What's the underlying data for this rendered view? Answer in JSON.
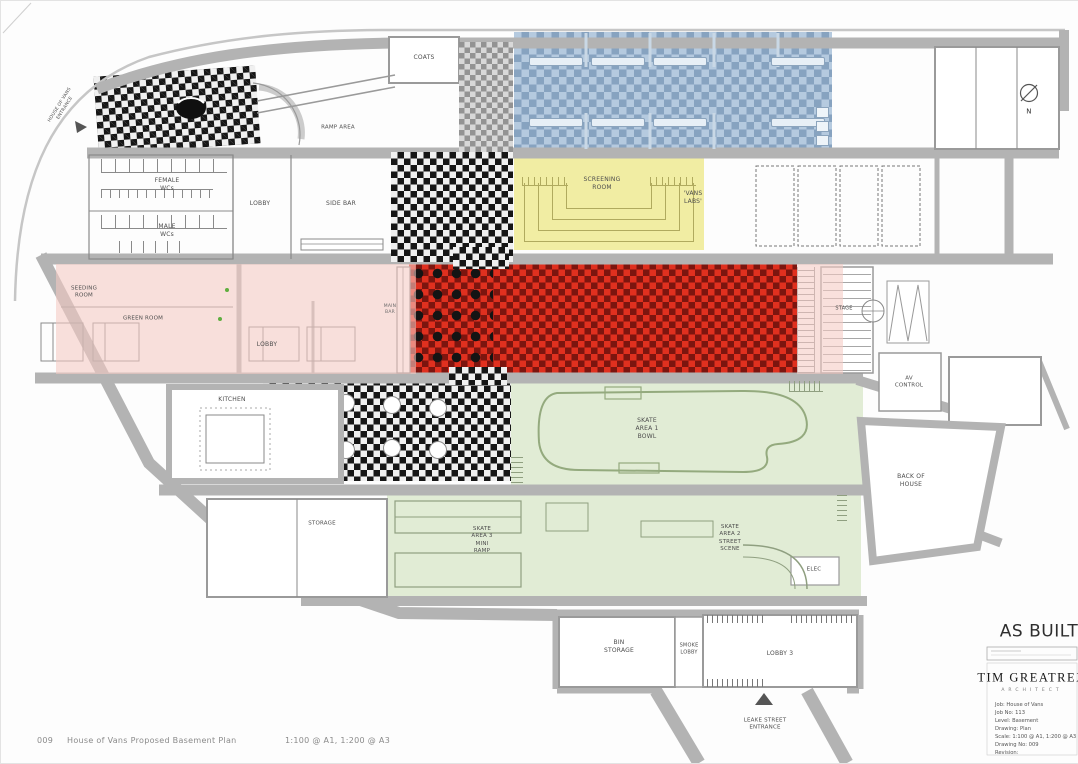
{
  "rooms": {
    "coats": "COATS",
    "ramp_area": "RAMP AREA",
    "hov_entrance": "HOUSE OF VANS\nENTRANCE",
    "female_wcs": "FEMALE\nWCs",
    "male_wcs": "MALE\nWCs",
    "lobby": "LOBBY",
    "side_bar": "SIDE BAR",
    "screening_room": "SCREENING\nROOM",
    "vans_labs": "'VANS\nLABS'",
    "seeding_room": "SEEDING\nROOM",
    "green_room": "GREEN ROOM",
    "lobby2": "LOBBY",
    "main_bar": "MAIN\nBAR",
    "stage": "STAGE",
    "av_control": "AV\nCONTROL",
    "kitchen": "KITCHEN",
    "skate_area_1": "SKATE\nAREA 1\nBOWL",
    "storage": "STORAGE",
    "skate_area_3": "SKATE\nAREA 3\nMINI\nRAMP",
    "skate_area_2": "SKATE\nAREA 2\nSTREET\nSCENE",
    "elec": "ELEC",
    "back_of_house": "BACK OF\nHOUSE",
    "bin_storage": "BIN\nSTORAGE",
    "smoke_lobby": "SMOKE\nLOBBY",
    "lobby3": "LOBBY 3",
    "leake_entrance": "LEAKE STREET\nENTRANCE",
    "north": "N"
  },
  "title_block": {
    "status": "AS BUILT",
    "firm": "TIM GREATREX",
    "firm_sub": "ARCHITECT",
    "info": [
      "Job: House of Vans",
      "Job No: 113",
      "Level: Basement",
      "Drawing: Plan",
      "Scale: 1:100 @ A1, 1:200 @ A3",
      "Drawing No: 009",
      "Revision:"
    ]
  },
  "footer": {
    "number": "009",
    "title": "House of Vans Proposed Basement Plan",
    "scale": "1:100 @ A1, 1:200 @ A3"
  },
  "colors": {
    "blue": "#b5cadf",
    "blue_dark": "#87a3c0",
    "red": "#e0301f",
    "red_dark": "#7c150f",
    "yellow": "#f1eda3",
    "pink": "#f4c9c2",
    "green": "#e1ecd5",
    "wall": "#b3b3b3"
  }
}
